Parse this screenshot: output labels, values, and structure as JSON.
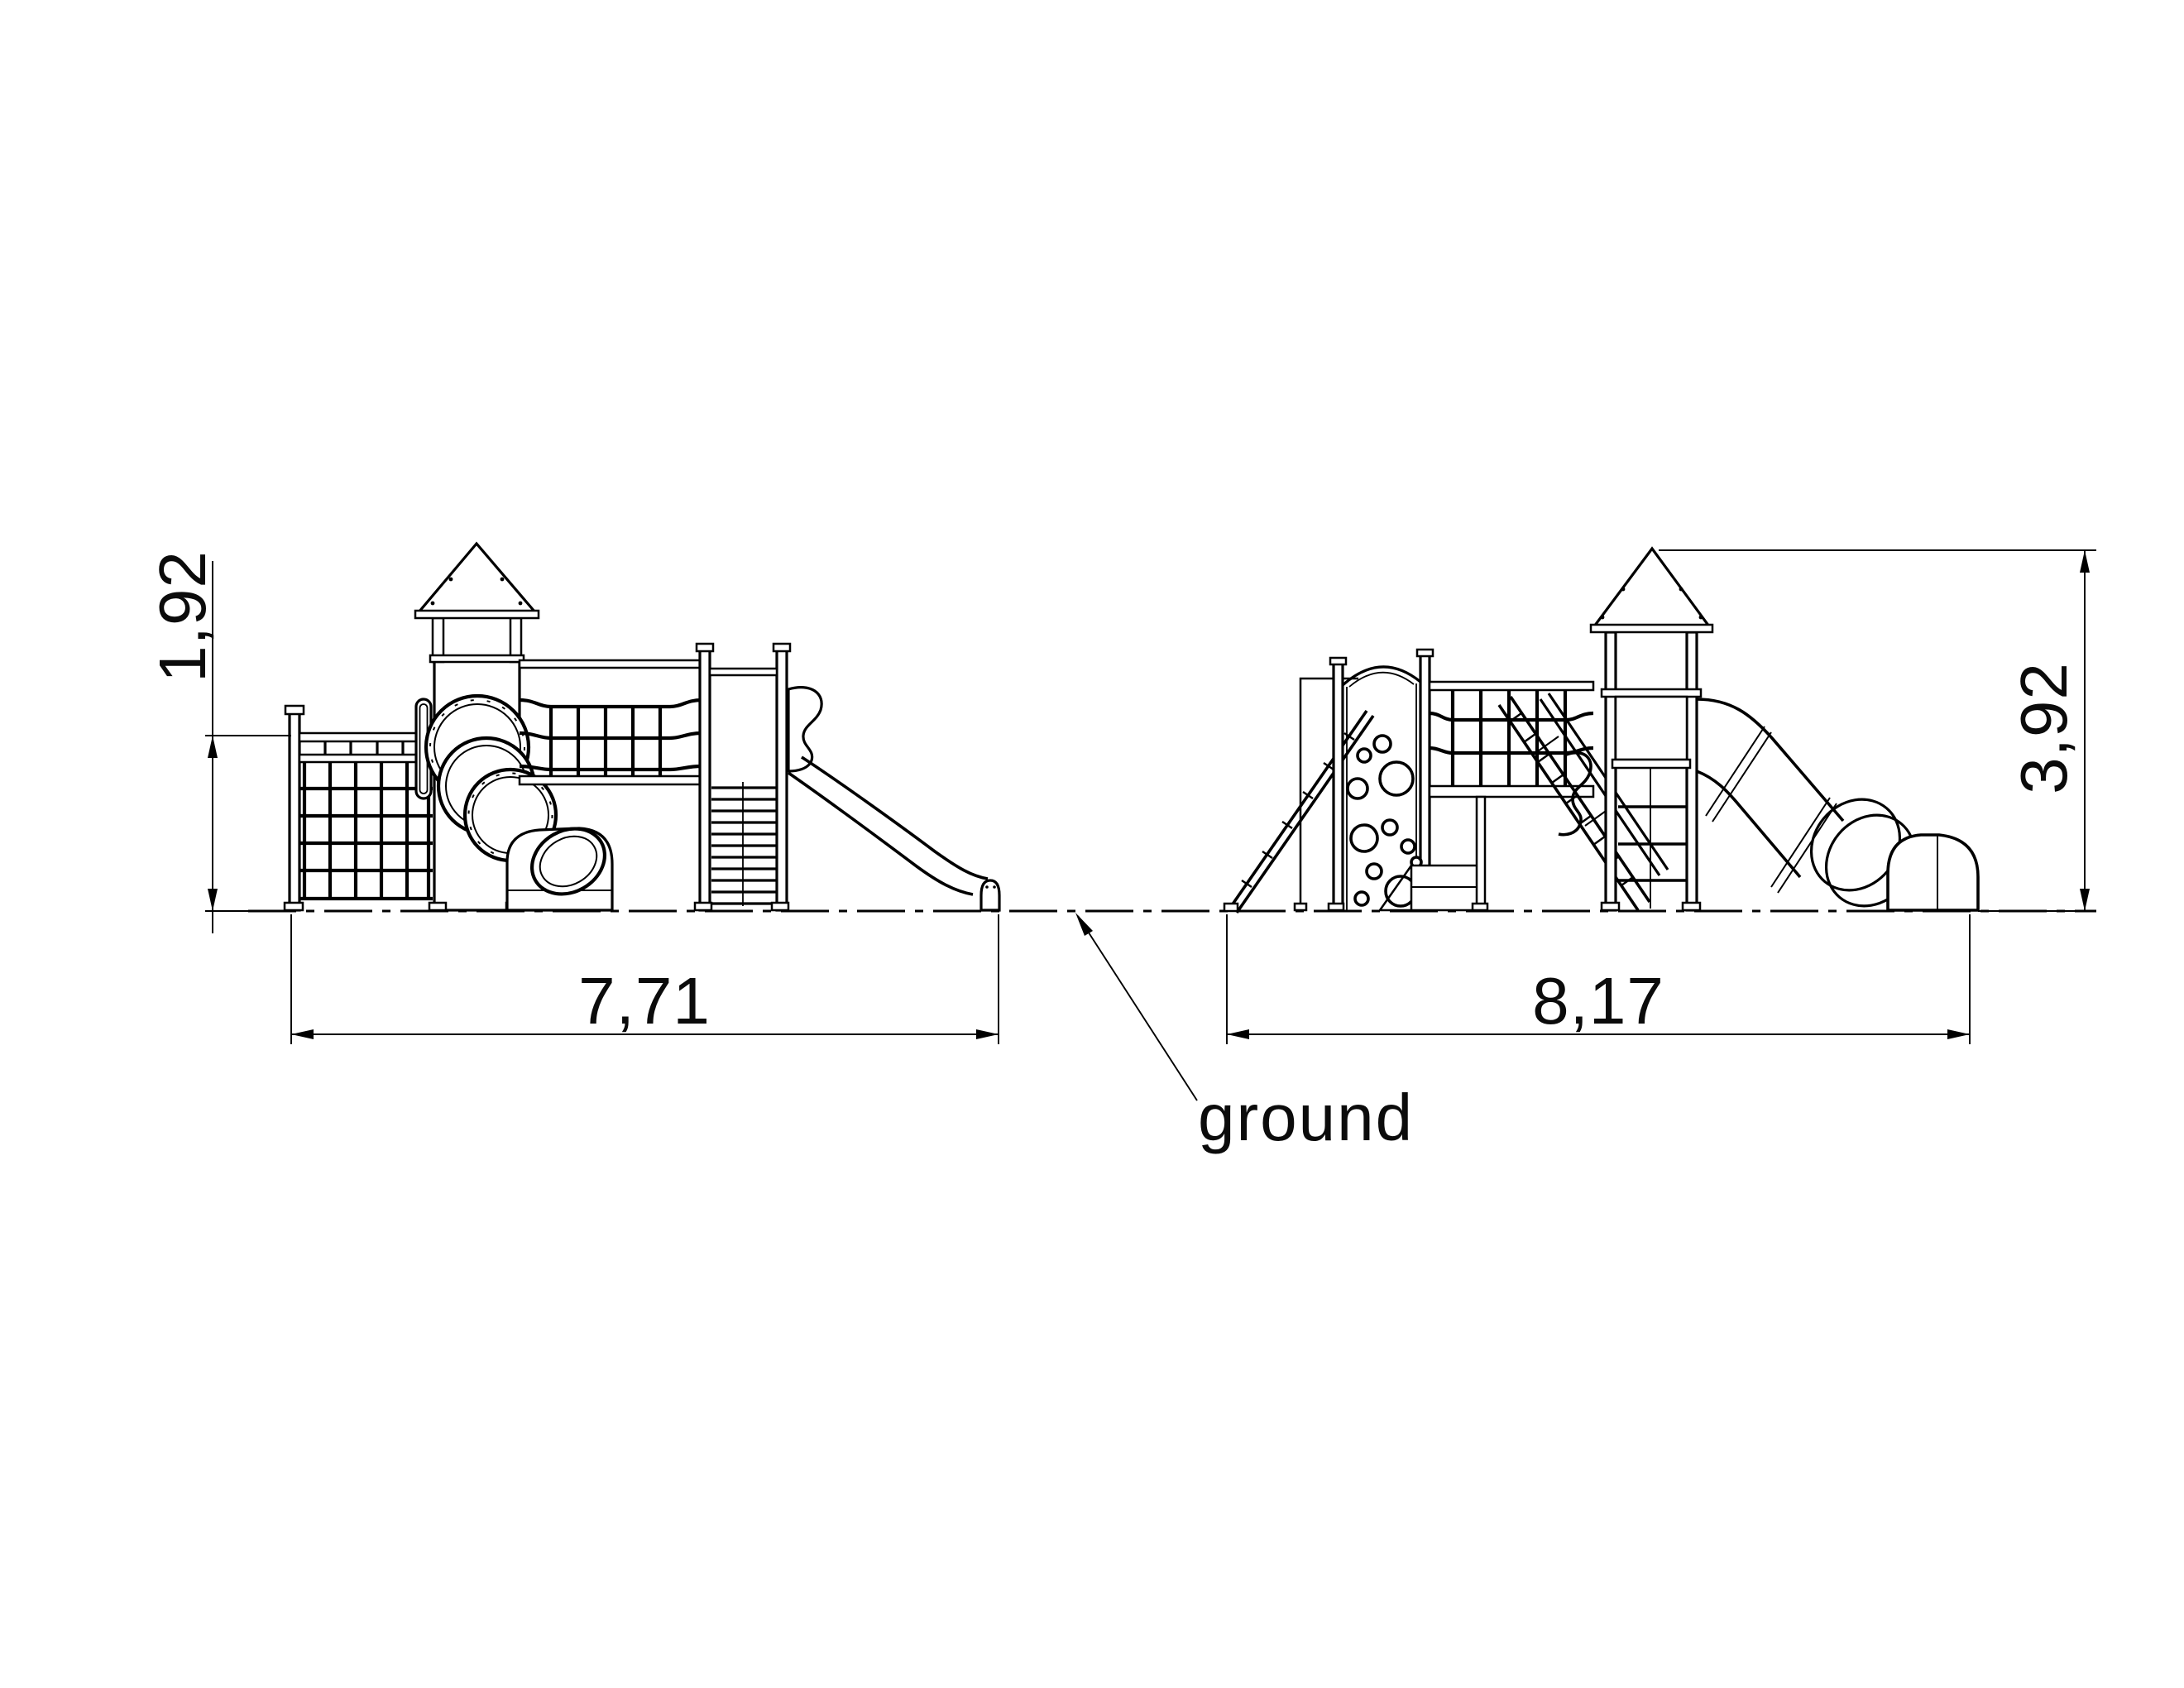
{
  "drawing": {
    "background": "#ffffff",
    "line_color": "#000000",
    "ground_label": "ground",
    "dimensions": {
      "left_view_height": "1,92",
      "left_view_width": "7,71",
      "right_view_width": "8,17",
      "right_view_height": "3,92"
    }
  }
}
